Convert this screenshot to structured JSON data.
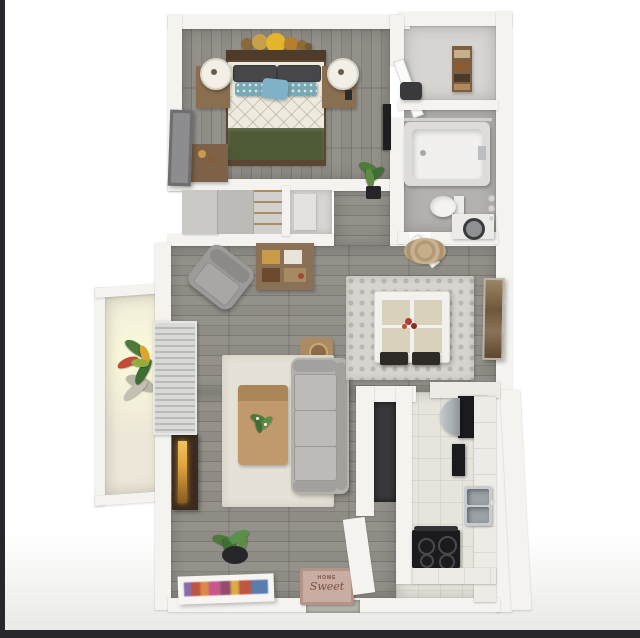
{
  "scene": {
    "description": "3D top-down rendering of a one-bedroom apartment floor plan",
    "doormat": {
      "line1": "HOME",
      "line2": "Sweet"
    }
  },
  "rooms": [
    {
      "name": "bedroom",
      "furniture": [
        "queen-bed",
        "nightstand-left",
        "nightstand-right",
        "table-lamps",
        "dresser",
        "leaning-mirror",
        "circle-wall-art"
      ]
    },
    {
      "name": "storage-closet",
      "furniture": [
        "shelf-unit",
        "dark-chair"
      ]
    },
    {
      "name": "bathroom",
      "furniture": [
        "bathtub-shower",
        "toilet",
        "washer",
        "towel-hooks"
      ]
    },
    {
      "name": "hallway",
      "furniture": [
        "sliding-door-closet",
        "linen-closet",
        "potted-plant",
        "round-rug",
        "wall-tv"
      ]
    },
    {
      "name": "living-room",
      "furniture": [
        "sofa",
        "armchair",
        "coffee-table",
        "side-table",
        "console-table",
        "area-rug",
        "fireplace",
        "vertical-blinds",
        "entry-plant",
        "leaning-artwork",
        "doormat"
      ]
    },
    {
      "name": "dining-area",
      "furniture": [
        "dining-table",
        "four-chairs",
        "mosaic-rug",
        "flower-centerpiece",
        "wall-art"
      ]
    },
    {
      "name": "kitchen",
      "furniture": [
        "refrigerator",
        "stainless-unit",
        "wall-oven",
        "double-sink",
        "range-stove",
        "counters",
        "laundry-nook"
      ]
    },
    {
      "name": "balcony",
      "furniture": [
        "flowering-plant"
      ]
    }
  ],
  "colors": {
    "letterbox": "#28282c",
    "wall": "#f4f3f0",
    "floor_wood": "#8f8c86",
    "floor_wood_line": "#7c7973",
    "bath_floor": "#b3b1ad",
    "closet_floor": "#d7d5d1",
    "kitchen_floor": "#e7e4dd",
    "balcony_floor": "#ece7d8",
    "headboard": "#4e3b2a",
    "mattress": "#efeadf",
    "blanket": "#4e5936",
    "pillow_dark": "#47474a",
    "pillow_teal": "#78a8b2",
    "pillow_blue": "#7fb2c9",
    "nightstand": "#8a6e50",
    "lamp": "#f2efe6",
    "dresser": "#7d6248",
    "mirror": "#6e6e70",
    "armchair": "#9c9b99",
    "console": "#8a7054",
    "side_table": "#a98c66",
    "area_rug": "#e6e1d6",
    "sofa": "#b3b2af",
    "sofa_trim": "#a2a19e",
    "coffee_table": "#c09a6d",
    "fireplace": "#3a2b1e",
    "flame": "#e0a43e",
    "blinds": "#d9d9d7",
    "plant_green": "#4e7a3a",
    "plant_red": "#c24b3a",
    "plant_yellow": "#d9a62e",
    "pot_dark": "#26262a",
    "mat": "#c9aca2",
    "mat_text": "#7a5044",
    "mosaic_rug": "#d6d4cf",
    "dining_table": "#f2f1ee",
    "table_panel": "#d9d2bb",
    "chair_dark": "#2e2a26",
    "flowers": "#b23a30",
    "counter": "#edebe6",
    "appliance_black": "#1b1b1d",
    "stainless": "#a9aeb2",
    "sink_steel": "#9aa0a4",
    "nook_dark": "#39393b",
    "rug_round": "#c6ae8b",
    "threshold": "#b4b4ac",
    "tub": "#f1f0ee"
  }
}
